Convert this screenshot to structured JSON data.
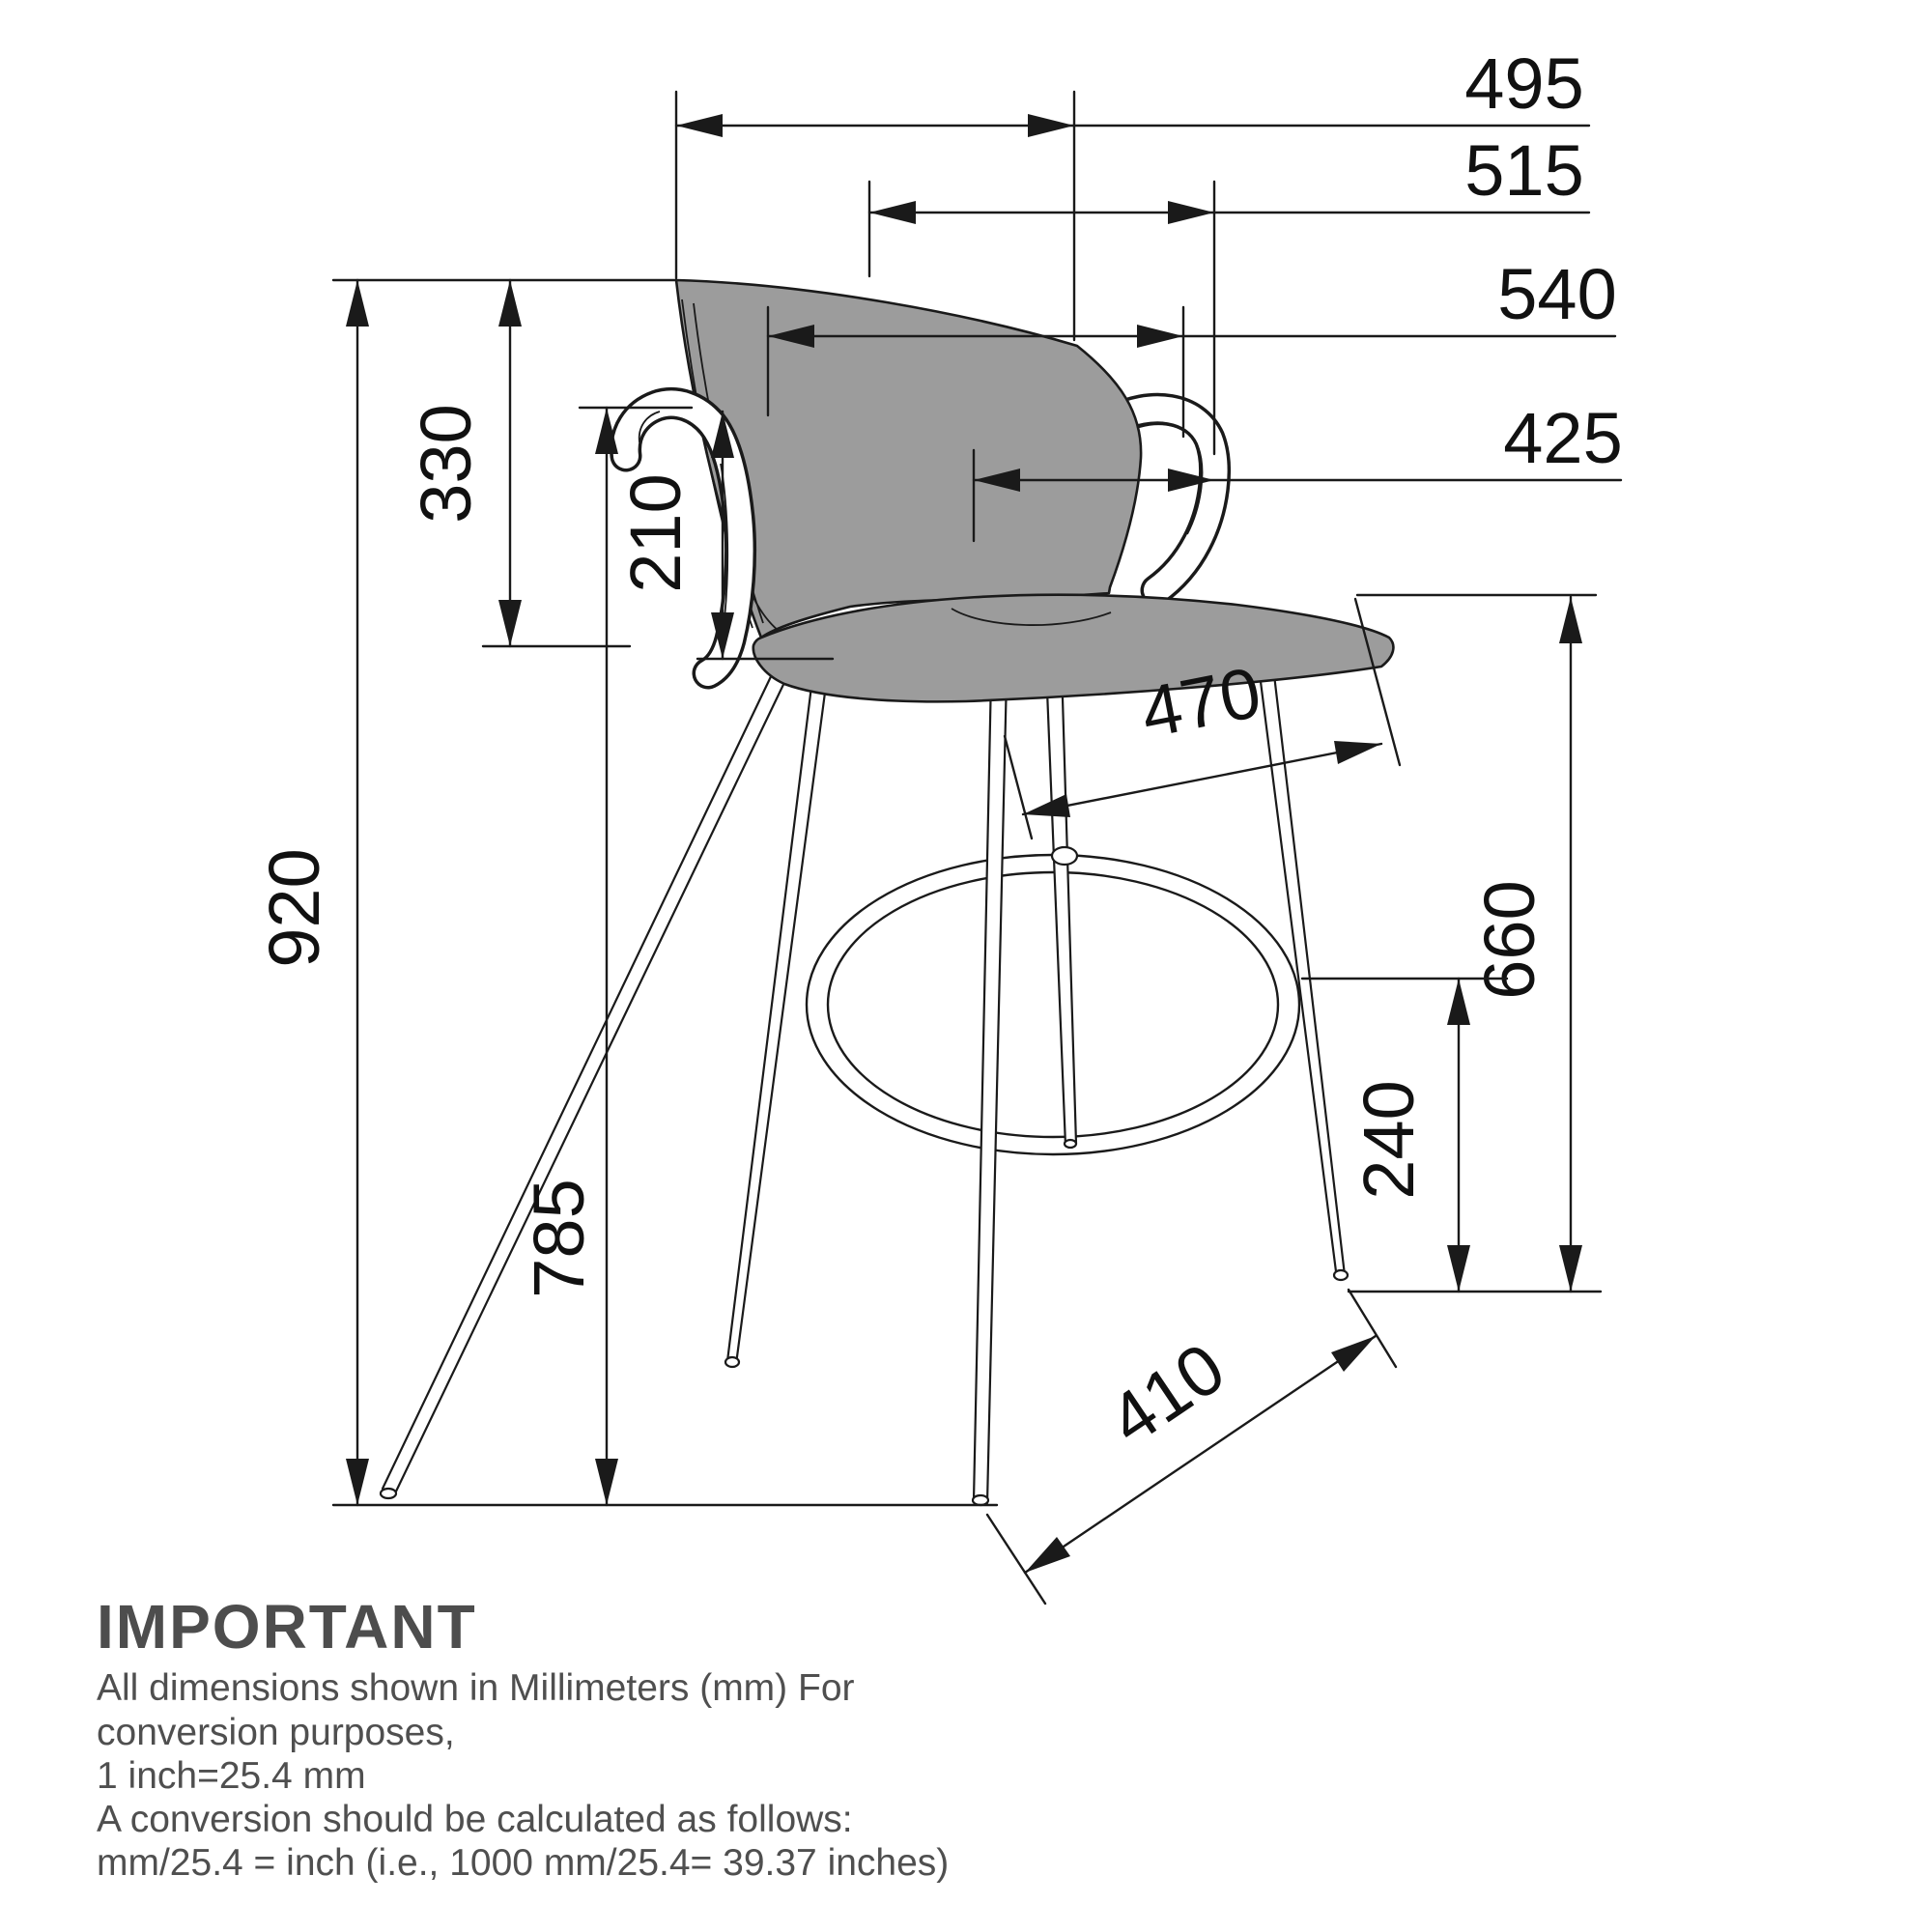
{
  "dims": {
    "d495": "495",
    "d515": "515",
    "d540": "540",
    "d425": "425",
    "d330": "330",
    "d210": "210",
    "d920": "920",
    "d785": "785",
    "d470": "470",
    "d660": "660",
    "d240": "240",
    "d410": "410"
  },
  "note": {
    "heading": "IMPORTANT",
    "line1": "All dimensions shown in Millimeters (mm) For",
    "line2": "conversion purposes,",
    "line3": "1 inch=25.4 mm",
    "line4": "A conversion should be calculated as follows:",
    "line5": "mm/25.4 = inch (i.e., 1000 mm/25.4= 39.37 inches)"
  },
  "units": "mm",
  "colors": {
    "line": "#1a1a1a",
    "upholstery": "#9c9c9c",
    "metal": "#ffffff",
    "note_text": "#4d4d4d",
    "background": "#ffffff"
  }
}
